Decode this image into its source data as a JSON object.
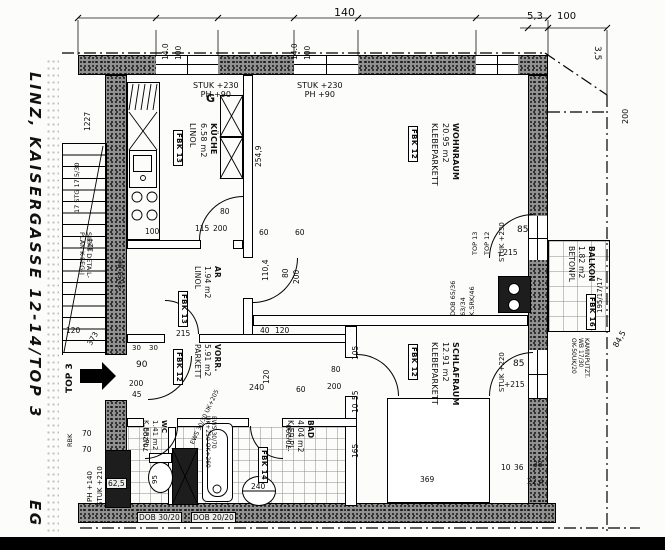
{
  "title": {
    "text": "LINZ, KAISERGASSE 12-14/TOP 3",
    "floor_label": "EG"
  },
  "plan": {
    "rooms": [
      {
        "id": "kueche",
        "name": "KÜCHE",
        "area": "6.58 m2",
        "floor": "LINOL",
        "fbk": "FBK 13",
        "fs": 8,
        "label": {
          "x": 218,
          "y": 123
        },
        "fbk_pos": {
          "x": 183,
          "y": 130
        }
      },
      {
        "id": "wohnraum",
        "name": "WOHNRAUM",
        "area": "20.95 m2",
        "floor": "KLEBEPARKETT",
        "fbk": "FBK 12",
        "fs": 8,
        "label": {
          "x": 460,
          "y": 123
        },
        "fbk_pos": {
          "x": 418,
          "y": 126
        }
      },
      {
        "id": "abstellraum",
        "name": "AR",
        "area": "1.94 m2",
        "floor": "LINOL",
        "fbk": "FBK 13",
        "fs": 7.5,
        "label": {
          "x": 222,
          "y": 266
        },
        "fbk_pos": {
          "x": 188,
          "y": 291
        }
      },
      {
        "id": "vorraum",
        "name": "VORR.",
        "area": "5.91 m2",
        "floor": "PARKETT",
        "fbk": "FBK 12",
        "fs": 7.5,
        "label": {
          "x": 222,
          "y": 344
        },
        "fbk_pos": {
          "x": 183,
          "y": 349
        }
      },
      {
        "id": "schlafraum",
        "name": "SCHLAFRAUM",
        "area": "12.91 m2",
        "floor": "KLEBEPARKETT",
        "fbk": "FBK 12",
        "fs": 8,
        "label": {
          "x": 460,
          "y": 342
        },
        "fbk_pos": {
          "x": 418,
          "y": 344
        }
      },
      {
        "id": "wc",
        "name": "WC",
        "area": "1.41 m2",
        "floor": "K.ER.PL.",
        "fbk": null,
        "fs": 7,
        "label": {
          "x": 168,
          "y": 420
        },
        "fbk_pos": null
      },
      {
        "id": "bad",
        "name": "BAD",
        "area": "4.04 m2",
        "floor": "K.ER.PL.",
        "fbk": "FBK 14",
        "fs": 7.5,
        "label": {
          "x": 315,
          "y": 420
        },
        "fbk_pos": {
          "x": 268,
          "y": 447
        }
      },
      {
        "id": "balkon",
        "name": "BALKON",
        "area": "1.82 m2",
        "floor": "BETONPL",
        "fbk": "FBK 16",
        "fs": 7.5,
        "label": {
          "x": 596,
          "y": 246
        },
        "fbk_pos": {
          "x": 596,
          "y": 294
        }
      }
    ],
    "annotations": [
      {
        "id": "dim-140",
        "text": "140",
        "x": 334,
        "y": 7,
        "rot": 0,
        "fs": 11
      },
      {
        "id": "dim-14-0-a",
        "text": "14.0",
        "x": 162,
        "y": 60,
        "rot": -90,
        "fs": 7.5
      },
      {
        "id": "dim-100-a",
        "text": "100",
        "x": 175,
        "y": 60,
        "rot": -90,
        "fs": 7.5
      },
      {
        "id": "dim-14-0-b",
        "text": "14.0",
        "x": 291,
        "y": 60,
        "rot": -90,
        "fs": 7.5
      },
      {
        "id": "dim-100-b",
        "text": "100",
        "x": 304,
        "y": 60,
        "rot": -90,
        "fs": 7.5
      },
      {
        "id": "dim-5-3",
        "text": "5,3",
        "x": 527,
        "y": 12,
        "rot": 0,
        "fs": 10
      },
      {
        "id": "dim-100-right",
        "text": "100",
        "x": 557,
        "y": 12,
        "rot": 0,
        "fs": 10
      },
      {
        "id": "dim-3-5",
        "text": "3,5",
        "x": 601,
        "y": 46,
        "rot": 90,
        "fs": 9
      },
      {
        "id": "dim-200-right",
        "text": "200",
        "x": 622,
        "y": 124,
        "rot": -90,
        "fs": 8
      },
      {
        "id": "dim-84-5",
        "text": "84,5",
        "x": 612,
        "y": 345,
        "rot": -60,
        "fs": 8
      },
      {
        "id": "stuk-kueche",
        "text": "STUK +230\nPH +90",
        "x": 193,
        "y": 82,
        "rot": 0,
        "fs": 8,
        "cls": "center"
      },
      {
        "id": "dim-1227",
        "text": "1227",
        "x": 84,
        "y": 131,
        "rot": -90,
        "fs": 7.5
      },
      {
        "id": "gas-mark",
        "text": "G",
        "x": 206,
        "y": 93,
        "rot": 0,
        "fs": 11,
        "cls": "bold"
      },
      {
        "id": "dim-100-kueche",
        "text": "100",
        "x": 145,
        "y": 228,
        "rot": 0,
        "fs": 7.5
      },
      {
        "id": "door-kueche-80",
        "text": "80",
        "x": 220,
        "y": 208,
        "rot": 0,
        "fs": 7.5
      },
      {
        "id": "door-kueche-200",
        "text": "200",
        "x": 213,
        "y": 225,
        "rot": 0,
        "fs": 7.5
      },
      {
        "id": "dim-115",
        "text": "115",
        "x": 195,
        "y": 225,
        "rot": 0,
        "fs": 7.5
      },
      {
        "id": "stuk-wohnraum",
        "text": "STUK +230\nPH +90",
        "x": 297,
        "y": 82,
        "rot": 0,
        "fs": 8,
        "cls": "center"
      },
      {
        "id": "dim-254-9",
        "text": "254,9",
        "x": 255,
        "y": 167,
        "rot": -90,
        "fs": 7.5
      },
      {
        "id": "dim-60-a",
        "text": "60",
        "x": 259,
        "y": 229,
        "rot": 0,
        "fs": 7.5
      },
      {
        "id": "dim-60-b",
        "text": "60",
        "x": 295,
        "y": 229,
        "rot": 0,
        "fs": 7.5
      },
      {
        "id": "dim-110-4",
        "text": "110,4",
        "x": 262,
        "y": 281,
        "rot": -90,
        "fs": 7.5
      },
      {
        "id": "door-wohn-80",
        "text": "80",
        "x": 282,
        "y": 278,
        "rot": -90,
        "fs": 7.5
      },
      {
        "id": "door-wohn-200",
        "text": "200",
        "x": 293,
        "y": 284,
        "rot": -90,
        "fs": 7.5
      },
      {
        "id": "dim-40",
        "text": "40",
        "x": 260,
        "y": 327,
        "rot": 0,
        "fs": 7.5
      },
      {
        "id": "dim-120-wohn",
        "text": "120",
        "x": 275,
        "y": 327,
        "rot": 0,
        "fs": 7.5
      },
      {
        "id": "balkontuer-85",
        "text": "85",
        "x": 517,
        "y": 226,
        "rot": 0,
        "fs": 9
      },
      {
        "id": "balkontuer-stuk",
        "text": "STUK +230",
        "x": 499,
        "y": 262,
        "rot": -90,
        "fs": 7
      },
      {
        "id": "balkontuer-215",
        "text": "+215",
        "x": 497,
        "y": 249,
        "r ot": 0,
        "rot": 0,
        "fs": 7.5
      },
      {
        "id": "top-13",
        "text": "TOP 13",
        "x": 472,
        "y": 255,
        "rot": -90,
        "fs": 6.5
      },
      {
        "id": "top-12",
        "text": "TOP 12",
        "x": 484,
        "y": 255,
        "rot": -90,
        "fs": 6.5
      },
      {
        "id": "dob-65-36",
        "text": "DOB 65/36",
        "x": 450,
        "y": 316,
        "rot": -90,
        "fs": 6.5
      },
      {
        "id": "dim-63-34",
        "text": "63/34",
        "x": 460,
        "y": 316,
        "rot": -90,
        "fs": 6.5
      },
      {
        "id": "k-srk-46",
        "text": "K.SRK/46",
        "x": 469,
        "y": 316,
        "rot": -90,
        "fs": 6.5
      },
      {
        "id": "kaminputz",
        "text": "KAMINPUTZT.\nWB 17/30\nOK-50UK/20",
        "x": 589,
        "y": 338,
        "rot": 90,
        "fs": 6
      },
      {
        "id": "dim-195-17",
        "text": "195/17/17",
        "x": 597,
        "y": 313,
        "rot": -90,
        "fs": 7
      },
      {
        "id": "dim-105",
        "text": "105",
        "x": 352,
        "y": 360,
        "rot": -90,
        "fs": 7.5
      },
      {
        "id": "dim-55",
        "text": "55",
        "x": 352,
        "y": 400,
        "rot": -90,
        "fs": 7.5
      },
      {
        "id": "dim-10",
        "text": "10",
        "x": 352,
        "y": 413,
        "rot": -90,
        "fs": 7.5
      },
      {
        "id": "dim-165",
        "text": "165",
        "x": 352,
        "y": 458,
        "rot": -90,
        "fs": 7.5
      },
      {
        "id": "door-schlaf-80",
        "text": "80",
        "x": 331,
        "y": 366,
        "rot": 0,
        "fs": 7.5
      },
      {
        "id": "door-schlaf-200",
        "text": "200",
        "x": 327,
        "y": 383,
        "rot": 0,
        "fs": 7.5
      },
      {
        "id": "fenster-85",
        "text": "85",
        "x": 513,
        "y": 360,
        "rot": 0,
        "fs": 9
      },
      {
        "id": "fenster-stuk",
        "text": "STUK +220",
        "x": 499,
        "y": 392,
        "rot": -90,
        "fs": 7
      },
      {
        "id": "fenster-215",
        "text": "+215",
        "x": 504,
        "y": 381,
        "rot": 0,
        "fs": 7.5
      },
      {
        "id": "dim-369",
        "text": "369",
        "x": 420,
        "y": 476,
        "rot": 0,
        "fs": 7.5
      },
      {
        "id": "dim-10b",
        "text": "10",
        "x": 501,
        "y": 464,
        "rot": 0,
        "fs": 7.5
      },
      {
        "id": "dim-36",
        "text": "36",
        "x": 514,
        "y": 464,
        "rot": 0,
        "fs": 7.5
      },
      {
        "id": "dim-38",
        "text": "38",
        "x": 533,
        "y": 461,
        "rot": 0,
        "fs": 7.5
      },
      {
        "id": "dim-22-4",
        "text": "22,4",
        "x": 527,
        "y": 478,
        "rot": 0,
        "fs": 7.5
      },
      {
        "id": "dim-215",
        "text": "215",
        "x": 176,
        "y": 330,
        "rot": 0,
        "fs": 7.5
      },
      {
        "id": "dim-30-a",
        "text": "30",
        "x": 132,
        "y": 345,
        "rot": 0,
        "fs": 7
      },
      {
        "id": "dim-30-b",
        "text": "30",
        "x": 149,
        "y": 345,
        "rot": 0,
        "fs": 7
      },
      {
        "id": "door-vorr-90",
        "text": "90",
        "x": 136,
        "y": 361,
        "rot": 0,
        "fs": 9
      },
      {
        "id": "door-vorr-200",
        "text": "200",
        "x": 129,
        "y": 380,
        "rot": 0,
        "fs": 7.5
      },
      {
        "id": "dim-45",
        "text": "45",
        "x": 132,
        "y": 391,
        "rot": 0,
        "fs": 7.5
      },
      {
        "id": "dim-240",
        "text": "240",
        "x": 249,
        "y": 384,
        "rot": 0,
        "fs": 8
      },
      {
        "id": "dim-120-vorr",
        "text": "120",
        "x": 263,
        "y": 384,
        "rot": -90,
        "fs": 7.5
      },
      {
        "id": "dim-60-vorr",
        "text": "60",
        "x": 296,
        "y": 386,
        "rot": 0,
        "fs": 7.5
      },
      {
        "id": "top3-arrow-label",
        "text": "TOP 3",
        "x": 66,
        "y": 393,
        "rot": -90,
        "fs": 9,
        "cls": "bold"
      },
      {
        "id": "stg-17",
        "text": "17 STG 17,5/30",
        "x": 74,
        "y": 213,
        "rot": -90,
        "fs": 6.5
      },
      {
        "id": "siehe-detail",
        "text": "SIEHE DETAIL-\nPLAN K-5EG-J",
        "x": 92,
        "y": 232,
        "rot": 90,
        "fs": 6.5
      },
      {
        "id": "db-15-15",
        "text": "DB 15/15",
        "x": 123,
        "y": 259,
        "rot": 90,
        "fs": 6.5
      },
      {
        "id": "dim-324",
        "text": "324",
        "x": 88,
        "y": 252,
        "rot": -90,
        "fs": 7
      },
      {
        "id": "dim-120-stair",
        "text": "120",
        "x": 66,
        "y": 327,
        "rot": 0,
        "fs": 7.5
      },
      {
        "id": "dim-373",
        "text": "373",
        "x": 86,
        "y": 343,
        "rot": -60,
        "fs": 7.5
      },
      {
        "id": "dim-70-a",
        "text": "70",
        "x": 82,
        "y": 430,
        "rot": 0,
        "fs": 7.5
      },
      {
        "id": "dim-70-b",
        "text": "70",
        "x": 82,
        "y": 446,
        "rot": 0,
        "fs": 7.5
      },
      {
        "id": "rbk",
        "text": "RBK",
        "x": 67,
        "y": 447,
        "rot": -90,
        "fs": 6.5
      },
      {
        "id": "stuk-210",
        "text": "STUK +210",
        "x": 97,
        "y": 506,
        "rot": -90,
        "fs": 7
      },
      {
        "id": "ph-140",
        "text": "PH +140",
        "x": 87,
        "y": 502,
        "rot": -90,
        "fs": 7
      },
      {
        "id": "door-wc-70-200",
        "text": "70/200",
        "x": 143,
        "y": 452,
        "rot": -90,
        "fs": 7
      },
      {
        "id": "wc-95",
        "text": "95",
        "x": 152,
        "y": 484,
        "rot": -90,
        "fs": 7
      },
      {
        "id": "ews-wanne",
        "text": "EWS 30/70\nUK+210 OK+260",
        "x": 216,
        "y": 416,
        "rot": 90,
        "fs": 6
      },
      {
        "id": "ews-30-30",
        "text": "EWS 30/30 UK+205",
        "x": 190,
        "y": 443,
        "rot": -65,
        "fs": 6
      },
      {
        "id": "door-bad-70-200",
        "text": "70/200",
        "x": 286,
        "y": 449,
        "rot": -90,
        "fs": 7
      },
      {
        "id": "boiler-240",
        "text": "240",
        "x": 251,
        "y": 483,
        "rot": 0,
        "fs": 7.5
      },
      {
        "id": "dim-62-5",
        "text": "62,5",
        "x": 106,
        "y": 478,
        "rot": 0,
        "fs": 7.5,
        "cls": "tag"
      },
      {
        "id": "dob-30-20",
        "text": "DOB 30/20",
        "x": 137,
        "y": 512,
        "rot": 0,
        "fs": 7.5,
        "cls": "tag"
      },
      {
        "id": "dob-20-20",
        "text": "DOB 20/20",
        "x": 191,
        "y": 512,
        "rot": 0,
        "fs": 7.5,
        "cls": "tag"
      }
    ]
  }
}
